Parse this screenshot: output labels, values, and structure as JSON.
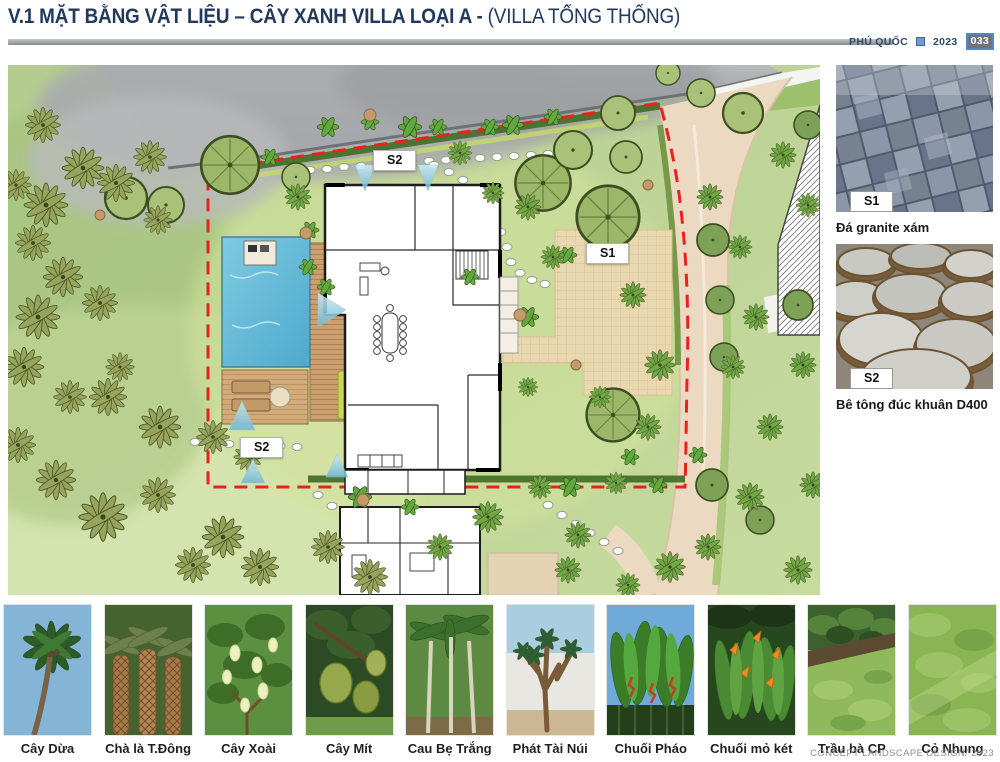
{
  "header": {
    "title_main": "V.1 MẶT BẰNG VẬT LIỆU – CÂY XANH VILLA LOẠI A",
    "title_sep": "-",
    "title_sub": "(VILLA TỔNG THỐNG)",
    "project": "PHÚ QUỐC",
    "year": "2023",
    "page_number": "033",
    "accent_navy": "#21395c",
    "accent_blue": "#4f86c6"
  },
  "plan": {
    "labels": {
      "s1": "S1",
      "s2": "S2"
    },
    "boundary_color": "#e8231d",
    "pool_color": "#5fb8d8"
  },
  "materials": [
    {
      "tag": "S1",
      "caption": "Đá granite xám"
    },
    {
      "tag": "S2",
      "caption": "Bê tông đúc khuân D400"
    }
  ],
  "plants": [
    {
      "label": "Cây Dừa"
    },
    {
      "label": "Chà là T.Đông"
    },
    {
      "label": "Cây Xoài"
    },
    {
      "label": "Cây Mít"
    },
    {
      "label": "Cau Bẹ Trắng"
    },
    {
      "label": "Phát Tài Núi"
    },
    {
      "label": "Chuối Pháo"
    },
    {
      "label": "Chuối mỏ két"
    },
    {
      "label": "Trầu bà CP"
    },
    {
      "label": "Cỏ Nhung"
    }
  ],
  "footer": {
    "credit": "CONCEPT LANDSCAPE DESIGN/ 2023"
  }
}
